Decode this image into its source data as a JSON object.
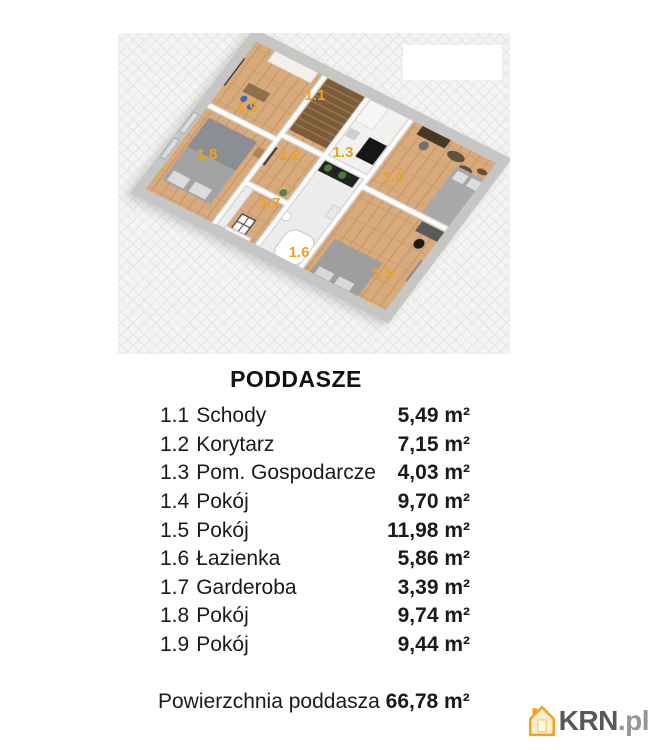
{
  "floorplan": {
    "title": "PODDASZE",
    "rooms": [
      {
        "number": "1.1",
        "name": "Schody",
        "area": "5,49 m²"
      },
      {
        "number": "1.2",
        "name": "Korytarz",
        "area": "7,15 m²"
      },
      {
        "number": "1.3",
        "name": "Pom. Gospodarcze",
        "area": "4,03 m²"
      },
      {
        "number": "1.4",
        "name": "Pokój",
        "area": "9,70 m²"
      },
      {
        "number": "1.5",
        "name": "Pokój",
        "area": "11,98 m²"
      },
      {
        "number": "1.6",
        "name": "Łazienka",
        "area": "5,86 m²"
      },
      {
        "number": "1.7",
        "name": "Garderoba",
        "area": "3,39 m²"
      },
      {
        "number": "1.8",
        "name": "Pokój",
        "area": "9,74 m²"
      },
      {
        "number": "1.9",
        "name": "Pokój",
        "area": "9,44 m²"
      }
    ],
    "total_label": "Powierzchnia poddasza",
    "total_value": "66,78 m²"
  },
  "watermark": {
    "brand": "KRN",
    "tld": ".pl"
  },
  "colors": {
    "room_label_orange": "#e9a41f",
    "wood_floor": "#d8aa7b",
    "outer_wall_gray": "#c6c6c5",
    "krn_orange": "#efa32a"
  }
}
